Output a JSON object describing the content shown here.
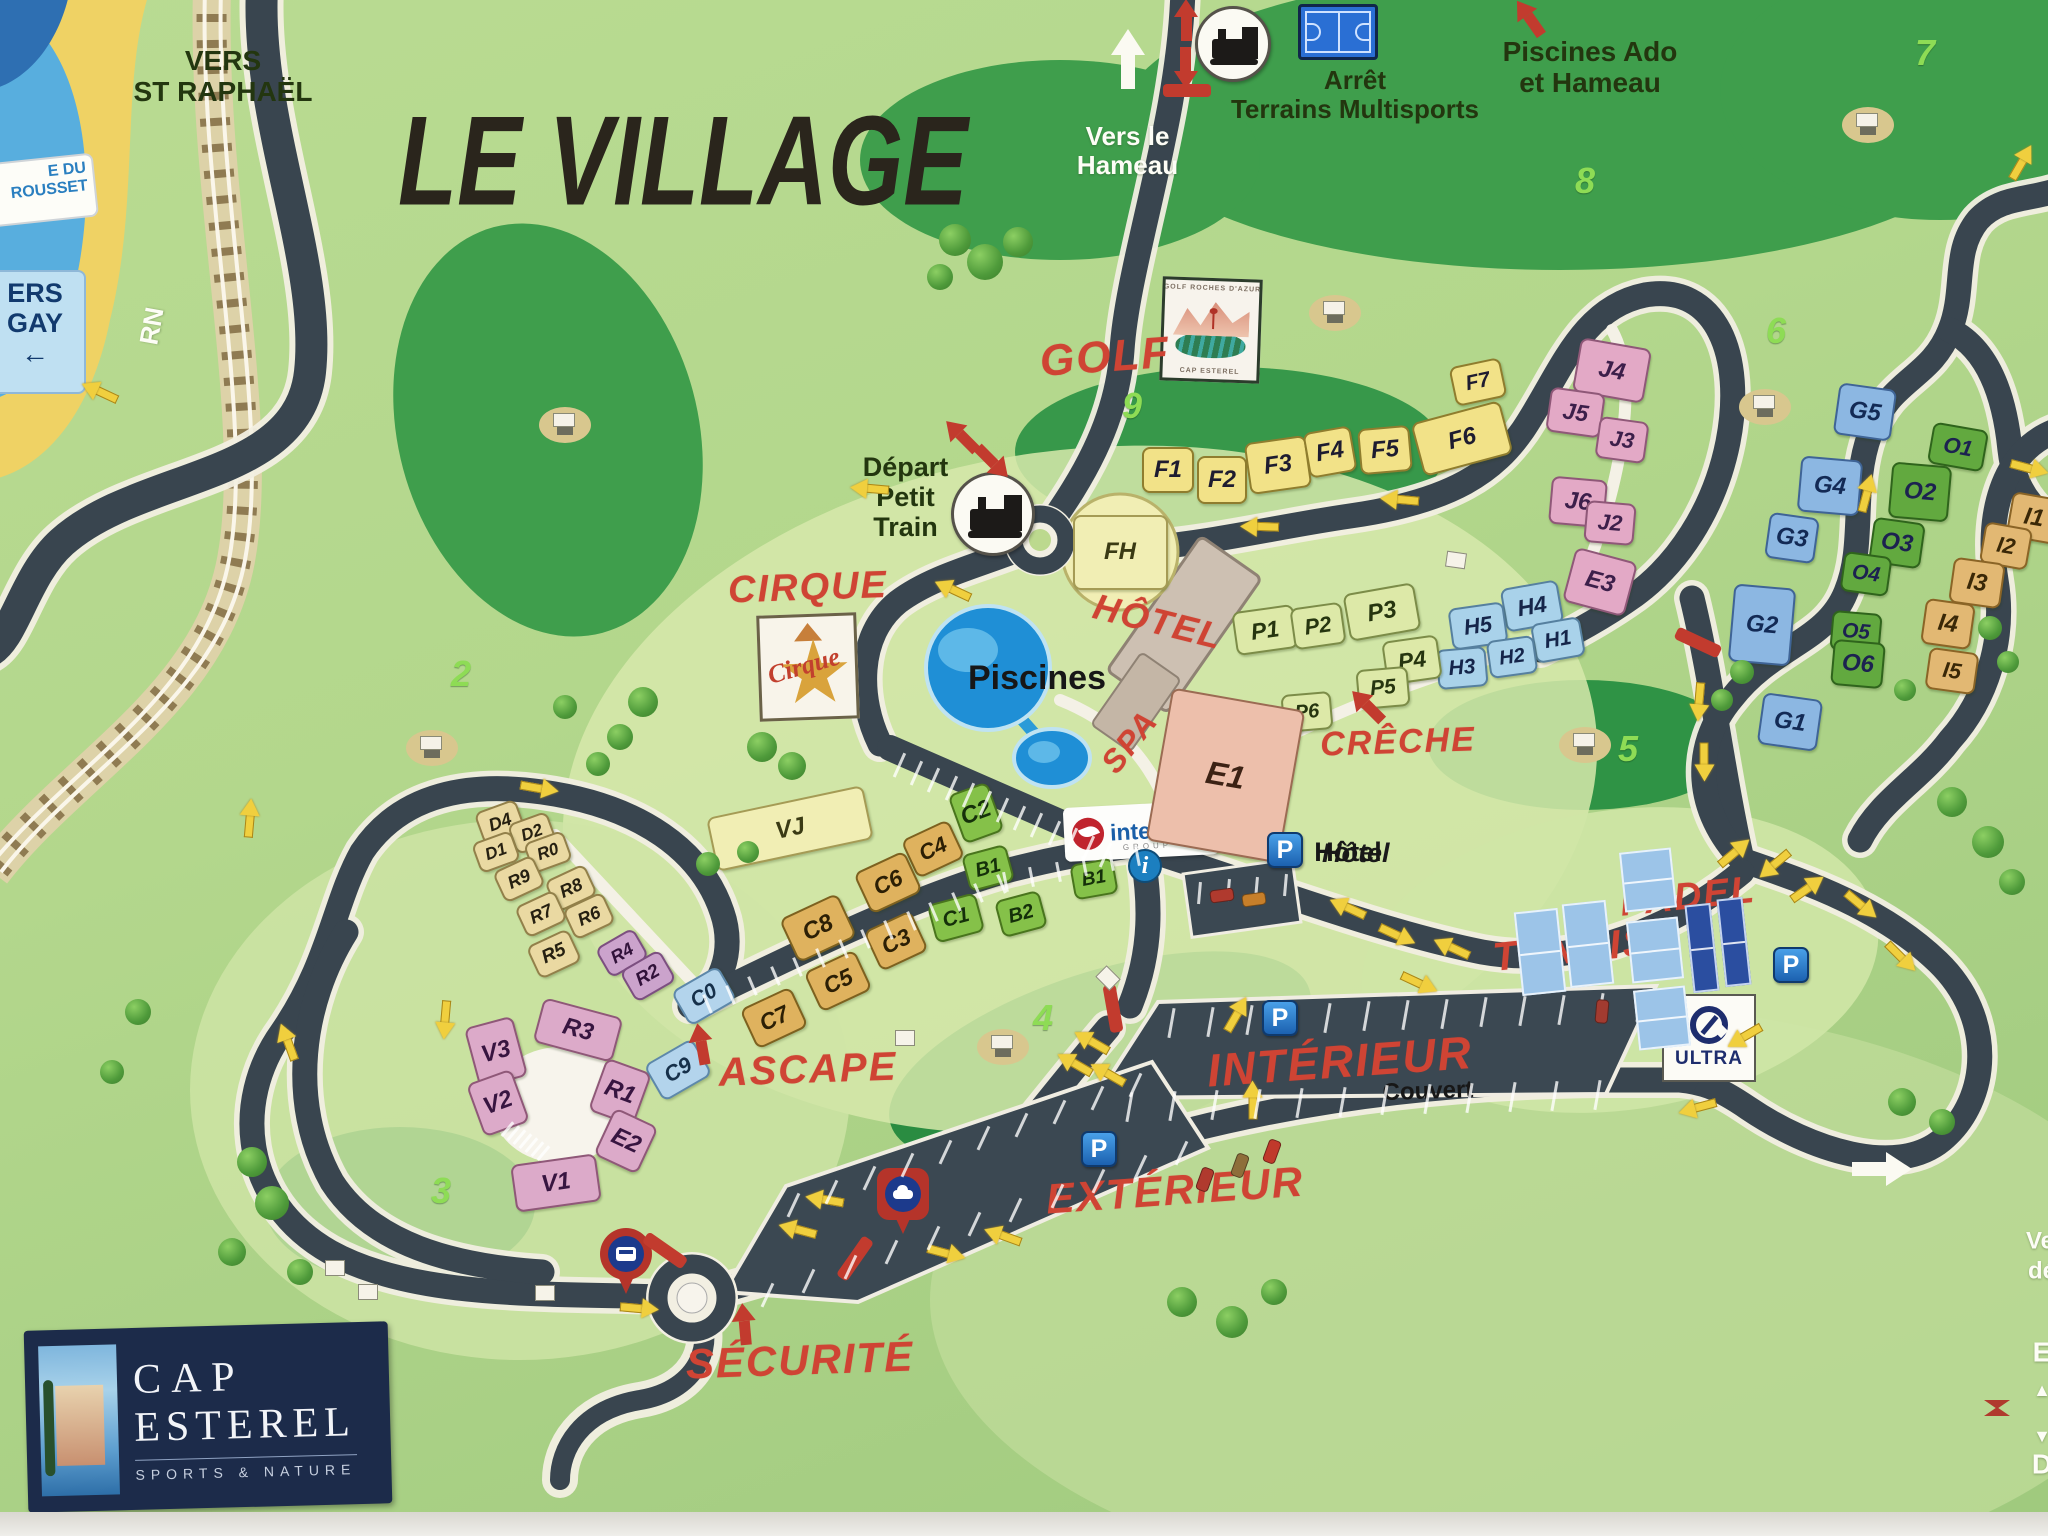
{
  "title": "LE VILLAGE",
  "signs": {
    "grousset": "E DU\nROUSSET",
    "agay": "ERS\nGAY",
    "agay_arrow": "←",
    "rn": "RN"
  },
  "directions": {
    "st_raphael": "VERS\nST RAPHAËL",
    "hameau": "Vers le\nHameau",
    "piscines_ado": "Piscines Ado\net Hameau",
    "arret_multisports": "Arrêt\nTerrains Multisports",
    "depart_petit_train": "Départ\nPetit\nTrain"
  },
  "logos": {
    "cap_line1": "CAP",
    "cap_line2": "ESTEREL",
    "cap_tagline": "SPORTS & NATURE",
    "interhome": "interhome",
    "interhome_sub": "GROUP",
    "ultra": "ULTRA",
    "golf_badge_top": "GOLF ROCHES D'AZUR",
    "golf_badge_bottom": "CAP ESTEREL",
    "cirque_badge": "Cirque"
  },
  "icons": {
    "parking_letter": "P",
    "info_letter": "i"
  },
  "parking_hotel_label": "Hôtel",
  "map": {
    "pois_red": [
      [
        "GOLF",
        1105,
        357,
        44,
        -4
      ],
      [
        "CIRQUE",
        808,
        588,
        38,
        -2
      ],
      [
        "HÔTEL",
        1158,
        622,
        36,
        14
      ],
      [
        "SPA",
        1130,
        742,
        32,
        -52
      ],
      [
        "CRÊCHE",
        1398,
        742,
        34,
        -2
      ],
      [
        "ASCAPE",
        808,
        1070,
        40,
        -2
      ],
      [
        "PADEL",
        1688,
        897,
        38,
        -6
      ],
      [
        "TENNIS",
        1572,
        950,
        40,
        -6
      ],
      [
        "INTÉRIEUR",
        1340,
        1062,
        46,
        -4
      ],
      [
        "EXTÉRIEUR",
        1175,
        1190,
        42,
        -4
      ],
      [
        "SÉCURITÉ",
        800,
        1360,
        42,
        -2
      ]
    ],
    "labels_dark": [
      [
        "Piscines",
        1037,
        678,
        34,
        0
      ],
      [
        "Hôtel",
        1348,
        852,
        27,
        0
      ],
      [
        "Couvert",
        1428,
        1092,
        24,
        -2
      ]
    ],
    "labels_white": [
      [
        "RN",
        152,
        326,
        26,
        -80
      ],
      [
        "Ve",
        2040,
        1242,
        24,
        0
      ],
      [
        "dé",
        2042,
        1272,
        24,
        0
      ],
      [
        "E",
        2042,
        1352,
        28,
        0
      ],
      [
        "▲",
        2042,
        1390,
        18,
        0
      ],
      [
        "▼",
        2042,
        1436,
        18,
        0
      ],
      [
        "D",
        2042,
        1464,
        28,
        0
      ]
    ],
    "holes": [
      [
        "2",
        451,
        673
      ],
      [
        "3",
        431,
        1190
      ],
      [
        "4",
        1033,
        1017
      ],
      [
        "5",
        1618,
        748
      ],
      [
        "6",
        1766,
        330
      ],
      [
        "7",
        1915,
        52
      ],
      [
        "8",
        1575,
        180
      ],
      [
        "9",
        1122,
        405
      ]
    ],
    "buildings": [
      [
        "FH",
        1120,
        552,
        95,
        75,
        0,
        "fh"
      ],
      [
        "F1",
        1168,
        470,
        52,
        46,
        0,
        "yF"
      ],
      [
        "F2",
        1222,
        480,
        50,
        48,
        0,
        "yF"
      ],
      [
        "F3",
        1278,
        465,
        62,
        52,
        -8,
        "yF"
      ],
      [
        "F4",
        1330,
        452,
        48,
        46,
        -10,
        "yF"
      ],
      [
        "F5",
        1385,
        450,
        52,
        46,
        -5,
        "yF"
      ],
      [
        "F6",
        1462,
        438,
        92,
        55,
        -15,
        "yF"
      ],
      [
        "F7",
        1478,
        382,
        52,
        40,
        -12,
        "yF"
      ],
      [
        "J4",
        1612,
        370,
        72,
        55,
        10,
        "pJ"
      ],
      [
        "J5",
        1575,
        412,
        55,
        45,
        8,
        "pJ"
      ],
      [
        "J3",
        1622,
        440,
        50,
        42,
        8,
        "pJ"
      ],
      [
        "J6",
        1578,
        502,
        56,
        48,
        5,
        "pJ"
      ],
      [
        "J2",
        1610,
        523,
        50,
        42,
        5,
        "pJ"
      ],
      [
        "E3",
        1600,
        582,
        64,
        56,
        15,
        "pJ"
      ],
      [
        "H4",
        1532,
        606,
        58,
        44,
        -10,
        "bH"
      ],
      [
        "H5",
        1478,
        626,
        56,
        42,
        -8,
        "bH"
      ],
      [
        "H1",
        1558,
        640,
        50,
        40,
        -10,
        "bH"
      ],
      [
        "H2",
        1512,
        657,
        48,
        38,
        -8,
        "bH"
      ],
      [
        "H3",
        1462,
        668,
        50,
        40,
        -5,
        "bH"
      ],
      [
        "P1",
        1265,
        630,
        62,
        44,
        -8,
        "gP"
      ],
      [
        "P2",
        1318,
        626,
        52,
        42,
        -8,
        "gP"
      ],
      [
        "P3",
        1382,
        612,
        72,
        48,
        -10,
        "gP"
      ],
      [
        "P4",
        1412,
        660,
        56,
        44,
        -8,
        "gP"
      ],
      [
        "P5",
        1383,
        688,
        52,
        40,
        -5,
        "gP"
      ],
      [
        "P6",
        1307,
        712,
        50,
        38,
        -5,
        "gP"
      ],
      [
        "G5",
        1865,
        412,
        58,
        52,
        8,
        "bG"
      ],
      [
        "G4",
        1830,
        486,
        62,
        56,
        5,
        "bG"
      ],
      [
        "G3",
        1792,
        538,
        50,
        46,
        8,
        "bG"
      ],
      [
        "G2",
        1762,
        625,
        62,
        78,
        5,
        "bG"
      ],
      [
        "G1",
        1790,
        722,
        60,
        52,
        8,
        "bG"
      ],
      [
        "O1",
        1958,
        447,
        56,
        42,
        10,
        "gO"
      ],
      [
        "O2",
        1920,
        492,
        60,
        56,
        5,
        "gO"
      ],
      [
        "O3",
        1897,
        543,
        52,
        46,
        8,
        "gO"
      ],
      [
        "O4",
        1866,
        574,
        48,
        40,
        8,
        "gO"
      ],
      [
        "O5",
        1856,
        632,
        50,
        40,
        5,
        "gO"
      ],
      [
        "O6",
        1858,
        664,
        52,
        46,
        5,
        "gO"
      ],
      [
        "I1",
        2034,
        518,
        50,
        46,
        10,
        "tI"
      ],
      [
        "I2",
        2006,
        546,
        48,
        42,
        10,
        "tI"
      ],
      [
        "I3",
        1977,
        583,
        52,
        46,
        8,
        "tI"
      ],
      [
        "I4",
        1948,
        624,
        50,
        46,
        8,
        "tI"
      ],
      [
        "I5",
        1952,
        671,
        50,
        42,
        8,
        "tI"
      ],
      [
        "D4",
        500,
        822,
        44,
        34,
        -20,
        "tD"
      ],
      [
        "D2",
        532,
        833,
        42,
        32,
        -20,
        "tD"
      ],
      [
        "D1",
        496,
        852,
        42,
        32,
        -20,
        "tD"
      ],
      [
        "R0",
        548,
        852,
        42,
        32,
        -20,
        "tD"
      ],
      [
        "R9",
        519,
        879,
        44,
        34,
        -25,
        "tD"
      ],
      [
        "R8",
        571,
        888,
        44,
        34,
        -25,
        "tD"
      ],
      [
        "R7",
        541,
        914,
        44,
        34,
        -25,
        "tD"
      ],
      [
        "R6",
        589,
        916,
        44,
        34,
        -25,
        "tD"
      ],
      [
        "R5",
        554,
        954,
        46,
        36,
        -25,
        "tD"
      ],
      [
        "R4",
        622,
        953,
        44,
        34,
        -30,
        "mR"
      ],
      [
        "R2",
        648,
        976,
        46,
        36,
        -30,
        "mR"
      ],
      [
        "C0",
        704,
        996,
        54,
        40,
        -30,
        "lbC"
      ],
      [
        "C9",
        678,
        1070,
        56,
        42,
        -30,
        "lbC"
      ],
      [
        "VJ",
        790,
        828,
        160,
        55,
        -12,
        "fh"
      ],
      [
        "C4",
        933,
        849,
        52,
        42,
        -25,
        "gC"
      ],
      [
        "C6",
        888,
        882,
        56,
        45,
        -25,
        "gC"
      ],
      [
        "C8",
        818,
        928,
        64,
        48,
        -25,
        "gC"
      ],
      [
        "C3",
        896,
        941,
        52,
        44,
        -25,
        "gC"
      ],
      [
        "C5",
        838,
        981,
        56,
        44,
        -25,
        "gC"
      ],
      [
        "C7",
        774,
        1018,
        56,
        44,
        -25,
        "gC"
      ],
      [
        "C2",
        976,
        813,
        42,
        52,
        -20,
        "grB"
      ],
      [
        "C1",
        956,
        918,
        50,
        40,
        -15,
        "grB"
      ],
      [
        "B1",
        988,
        868,
        46,
        38,
        -15,
        "grB"
      ],
      [
        "B1",
        1094,
        879,
        44,
        36,
        -10,
        "grB"
      ],
      [
        "B2",
        1021,
        914,
        46,
        38,
        -15,
        "grB"
      ],
      [
        "R3",
        578,
        1030,
        82,
        46,
        15,
        "pV"
      ],
      [
        "V3",
        496,
        1052,
        50,
        62,
        -15,
        "pV"
      ],
      [
        "V2",
        498,
        1103,
        48,
        56,
        -20,
        "pV"
      ],
      [
        "R1",
        620,
        1092,
        48,
        56,
        20,
        "pV"
      ],
      [
        "E2",
        626,
        1141,
        48,
        52,
        25,
        "pV"
      ],
      [
        "V1",
        556,
        1183,
        86,
        48,
        -8,
        "pV"
      ],
      [
        "E1",
        1225,
        775,
        135,
        155,
        10,
        "sE1"
      ]
    ],
    "decor": {
      "arrows_yellow": [
        [
          100,
          392,
          205
        ],
        [
          870,
          489,
          185
        ],
        [
          953,
          590,
          205
        ],
        [
          1260,
          527,
          182
        ],
        [
          1400,
          500,
          185
        ],
        [
          1348,
          908,
          205
        ],
        [
          1398,
          935,
          25
        ],
        [
          1452,
          948,
          205
        ],
        [
          1420,
          983,
          25
        ],
        [
          1735,
          852,
          320
        ],
        [
          1775,
          865,
          140
        ],
        [
          1808,
          888,
          325
        ],
        [
          1700,
          702,
          95
        ],
        [
          1705,
          762,
          90
        ],
        [
          1862,
          905,
          40
        ],
        [
          1902,
          957,
          45
        ],
        [
          1867,
          493,
          285
        ],
        [
          1745,
          1037,
          150
        ],
        [
          1698,
          1108,
          165
        ],
        [
          2022,
          162,
          300
        ],
        [
          2030,
          468,
          15
        ],
        [
          250,
          818,
          275
        ],
        [
          288,
          1042,
          250
        ],
        [
          446,
          1020,
          95
        ],
        [
          640,
          1308,
          5
        ],
        [
          825,
          1200,
          190
        ],
        [
          798,
          1230,
          195
        ],
        [
          947,
          1253,
          15
        ],
        [
          1003,
          1236,
          200
        ],
        [
          1092,
          1042,
          210
        ],
        [
          1075,
          1064,
          210
        ],
        [
          1108,
          1074,
          210
        ],
        [
          1253,
          1100,
          270
        ],
        [
          1237,
          1014,
          300
        ],
        [
          540,
          788,
          10
        ]
      ],
      "arrows_red": [
        [
          1368,
          706,
          225
        ],
        [
          702,
          1044,
          260
        ],
        [
          745,
          1324,
          265
        ],
        [
          1530,
          18,
          235
        ],
        [
          1187,
          20,
          270
        ],
        [
          1187,
          68,
          90
        ],
        [
          962,
          436,
          225
        ],
        [
          994,
          462,
          45
        ]
      ],
      "bars_red": [
        [
          1187,
          90,
          0
        ],
        [
          1113,
          1008,
          80
        ],
        [
          665,
          1250,
          35
        ],
        [
          855,
          1258,
          -55
        ],
        [
          1698,
          642,
          25
        ]
      ],
      "trees": [
        [
          955,
          240,
          16
        ],
        [
          985,
          262,
          18
        ],
        [
          1018,
          242,
          15
        ],
        [
          940,
          277,
          13
        ],
        [
          762,
          747,
          15
        ],
        [
          792,
          766,
          14
        ],
        [
          643,
          702,
          15
        ],
        [
          620,
          737,
          13
        ],
        [
          565,
          707,
          12
        ],
        [
          598,
          764,
          12
        ],
        [
          252,
          1162,
          15
        ],
        [
          272,
          1203,
          17
        ],
        [
          232,
          1252,
          14
        ],
        [
          300,
          1272,
          13
        ],
        [
          1182,
          1302,
          15
        ],
        [
          1232,
          1322,
          16
        ],
        [
          1274,
          1292,
          13
        ],
        [
          1952,
          802,
          15
        ],
        [
          1988,
          842,
          16
        ],
        [
          2012,
          882,
          13
        ],
        [
          1902,
          1102,
          14
        ],
        [
          1942,
          1122,
          13
        ],
        [
          708,
          864,
          12
        ],
        [
          748,
          852,
          11
        ],
        [
          138,
          1012,
          13
        ],
        [
          112,
          1072,
          12
        ],
        [
          1742,
          672,
          12
        ],
        [
          1722,
          700,
          11
        ],
        [
          1905,
          690,
          11
        ],
        [
          1990,
          628,
          12
        ],
        [
          2008,
          662,
          11
        ]
      ],
      "huts": [
        [
          335,
          1268,
          0
        ],
        [
          368,
          1292,
          0
        ],
        [
          545,
          1293,
          0
        ],
        [
          905,
          1038,
          0
        ],
        [
          1108,
          978,
          45
        ],
        [
          1456,
          560,
          8
        ]
      ],
      "carts": [
        [
          565,
          425
        ],
        [
          432,
          748
        ],
        [
          1335,
          313
        ],
        [
          1868,
          125
        ],
        [
          1765,
          407
        ],
        [
          1585,
          745
        ],
        [
          1003,
          1047
        ]
      ],
      "stalls": [
        [
          1170,
          1008,
          1638,
          992,
          13,
          30,
          100
        ],
        [
          1128,
          1092,
          1596,
          1080,
          12,
          30,
          100
        ],
        [
          792,
          1192,
          1134,
          1072,
          10,
          26,
          115
        ],
        [
          766,
          1282,
          1180,
          1140,
          11,
          26,
          115
        ],
        [
          1198,
          882,
          1284,
          874,
          4,
          22,
          95
        ],
        [
          898,
          752,
          1104,
          842,
          13,
          26,
          114
        ],
        [
          706,
          994,
          1000,
          874,
          14,
          20,
          67
        ],
        [
          1004,
          872,
          1136,
          846,
          6,
          20,
          79
        ],
        [
          506,
          1120,
          542,
          1144,
          7,
          18,
          130
        ]
      ],
      "courts": [
        [
          1540,
          952,
          44,
          84,
          -6,
          "l"
        ],
        [
          1588,
          944,
          44,
          84,
          -6,
          "l"
        ],
        [
          1648,
          880,
          52,
          60,
          -6,
          "l"
        ],
        [
          1655,
          950,
          52,
          62,
          -6,
          "l"
        ],
        [
          1662,
          1018,
          52,
          60,
          -6,
          "l"
        ],
        [
          1702,
          948,
          26,
          88,
          -6,
          "d"
        ],
        [
          1734,
          942,
          26,
          88,
          -6,
          "d"
        ]
      ],
      "psigns": [
        [
          1285,
          850
        ],
        [
          1280,
          1018
        ],
        [
          1099,
          1149
        ],
        [
          1791,
          965
        ]
      ],
      "cars": [
        [
          1222,
          896,
          -8,
          "#b03a2e"
        ],
        [
          1254,
          900,
          -8,
          "#c77f2a"
        ],
        [
          1602,
          1012,
          95,
          "#a23b30"
        ],
        [
          1205,
          1180,
          110,
          "#b03a2e"
        ],
        [
          1240,
          1166,
          110,
          "#8e6e3a"
        ],
        [
          1272,
          1152,
          110,
          "#c0392b"
        ]
      ]
    }
  }
}
